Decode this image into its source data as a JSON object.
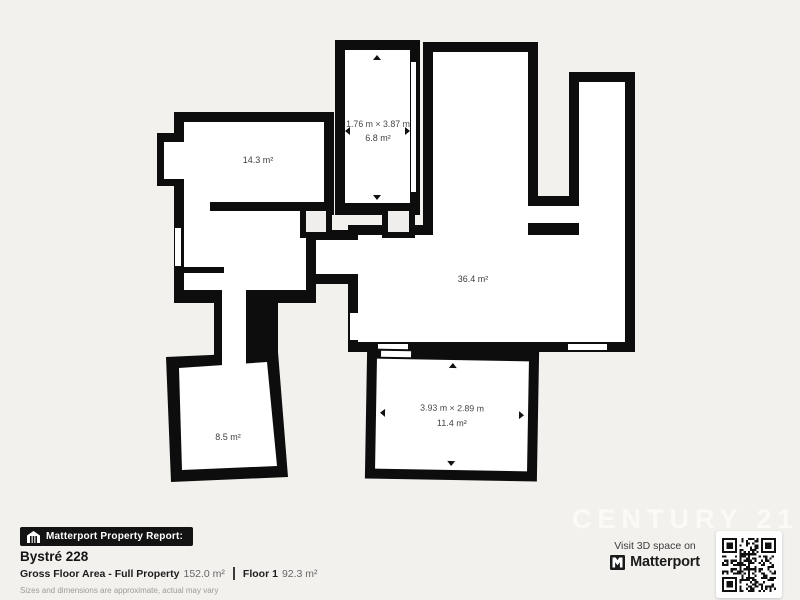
{
  "plan": {
    "rooms": [
      {
        "id": "room-14-3",
        "area": "14.3 m²"
      },
      {
        "id": "room-6-8",
        "dims": "1.76 m × 3.87 m",
        "area": "6.8 m²"
      },
      {
        "id": "room-36-4",
        "area": "36.4 m²"
      },
      {
        "id": "room-8-5",
        "area": "8.5 m²"
      },
      {
        "id": "room-11-4",
        "dims": "3.93 m × 2.89 m",
        "area": "11.4 m²"
      }
    ],
    "colors": {
      "wall": "#0d0d0d",
      "floor": "#ffffff",
      "background": "#f2f1ee"
    }
  },
  "footer": {
    "badge_label": "Matterport Property Report:",
    "property_name": "Bystré 228",
    "stats": {
      "gfa_label": "Gross Floor Area - Full Property",
      "gfa_value": "152.0 m²",
      "floor_label": "Floor 1",
      "floor_value": "92.3 m²"
    },
    "disclaimer": "Sizes and dimensions are approximate, actual may vary"
  },
  "cta": {
    "visit_text": "Visit 3D space on",
    "brand": "Matterport"
  },
  "watermark": "CENTURY 21"
}
